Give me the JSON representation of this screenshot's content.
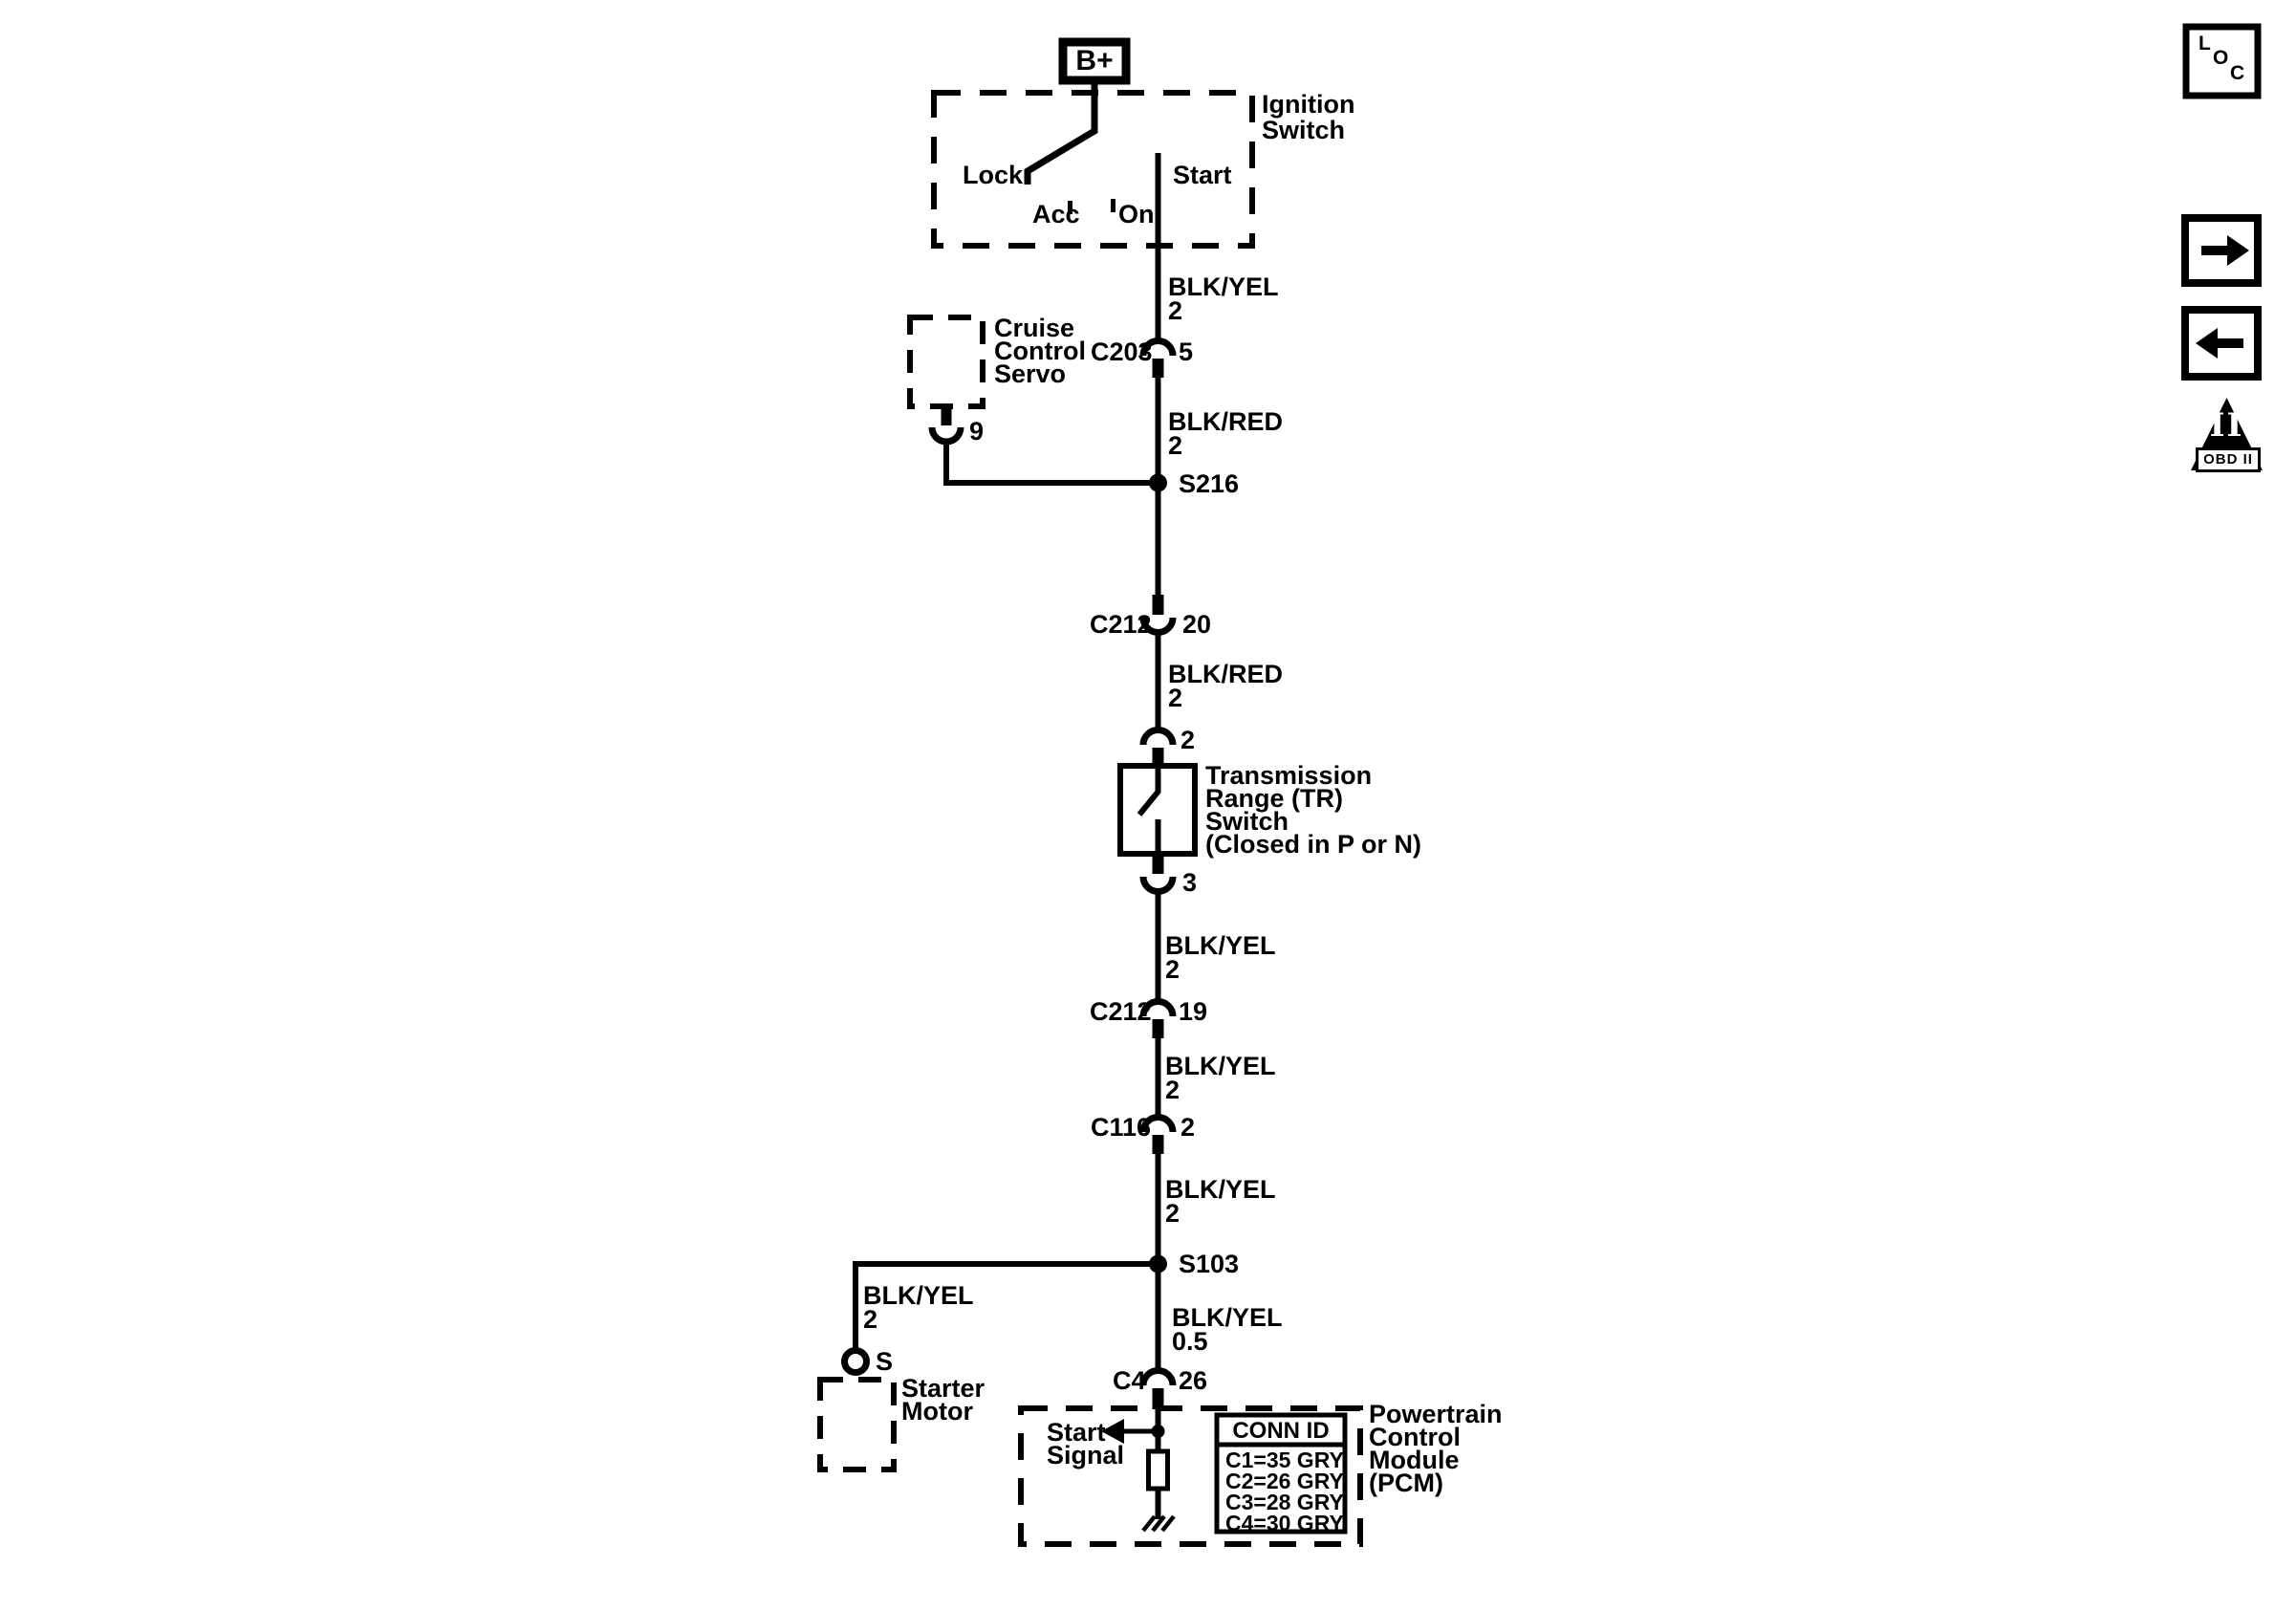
{
  "ignition": {
    "battery": "B+",
    "label": [
      "Ignition",
      "Switch"
    ],
    "positions": {
      "lock": "Lock",
      "acc": "Acc",
      "on": "On",
      "start": "Start"
    }
  },
  "cruise": {
    "label": [
      "Cruise",
      "Control",
      "Servo"
    ],
    "pin": "9"
  },
  "tr_switch": {
    "label": [
      "Transmission",
      "Range (TR)",
      "Switch",
      "(Closed in P or N)"
    ],
    "pin_in": "2",
    "pin_out": "3"
  },
  "starter": {
    "terminal": "S",
    "label": [
      "Starter",
      "Motor"
    ]
  },
  "pcm": {
    "signal": [
      "Start",
      "Signal"
    ],
    "label": [
      "Powertrain",
      "Control",
      "Module",
      "(PCM)"
    ],
    "conn_id": {
      "header": "CONN ID",
      "rows": [
        "C1=35 GRY",
        "C2=26 GRY",
        "C3=28 GRY",
        "C4=30 GRY"
      ]
    }
  },
  "connectors": {
    "c203": {
      "name": "C203",
      "pin": "5"
    },
    "c212_20": {
      "name": "C212",
      "pin": "20"
    },
    "c212_19": {
      "name": "C212",
      "pin": "19"
    },
    "c116": {
      "name": "C116",
      "pin": "2"
    },
    "c4": {
      "name": "C4",
      "pin": "26"
    }
  },
  "splices": {
    "s216": "S216",
    "s103": "S103"
  },
  "wires": {
    "w1": {
      "color": "BLK/YEL",
      "gauge": "2"
    },
    "w2": {
      "color": "BLK/RED",
      "gauge": "2"
    },
    "w3": {
      "color": "BLK/RED",
      "gauge": "2"
    },
    "w4": {
      "color": "BLK/RED",
      "gauge": "2"
    },
    "w5": {
      "color": "BLK/YEL",
      "gauge": "2"
    },
    "w6": {
      "color": "BLK/YEL",
      "gauge": "2"
    },
    "w7": {
      "color": "BLK/YEL",
      "gauge": "2"
    },
    "w8": {
      "color": "BLK/YEL",
      "gauge": "2"
    },
    "w9": {
      "color": "BLK/YEL",
      "gauge": "0.5"
    }
  },
  "nav": {
    "loc": {
      "l": "L",
      "o": "O",
      "c": "C"
    },
    "obd": {
      "numeral": "II",
      "label": "OBD II"
    }
  },
  "colors": {
    "ink": "#000000",
    "paper": "#ffffff"
  }
}
